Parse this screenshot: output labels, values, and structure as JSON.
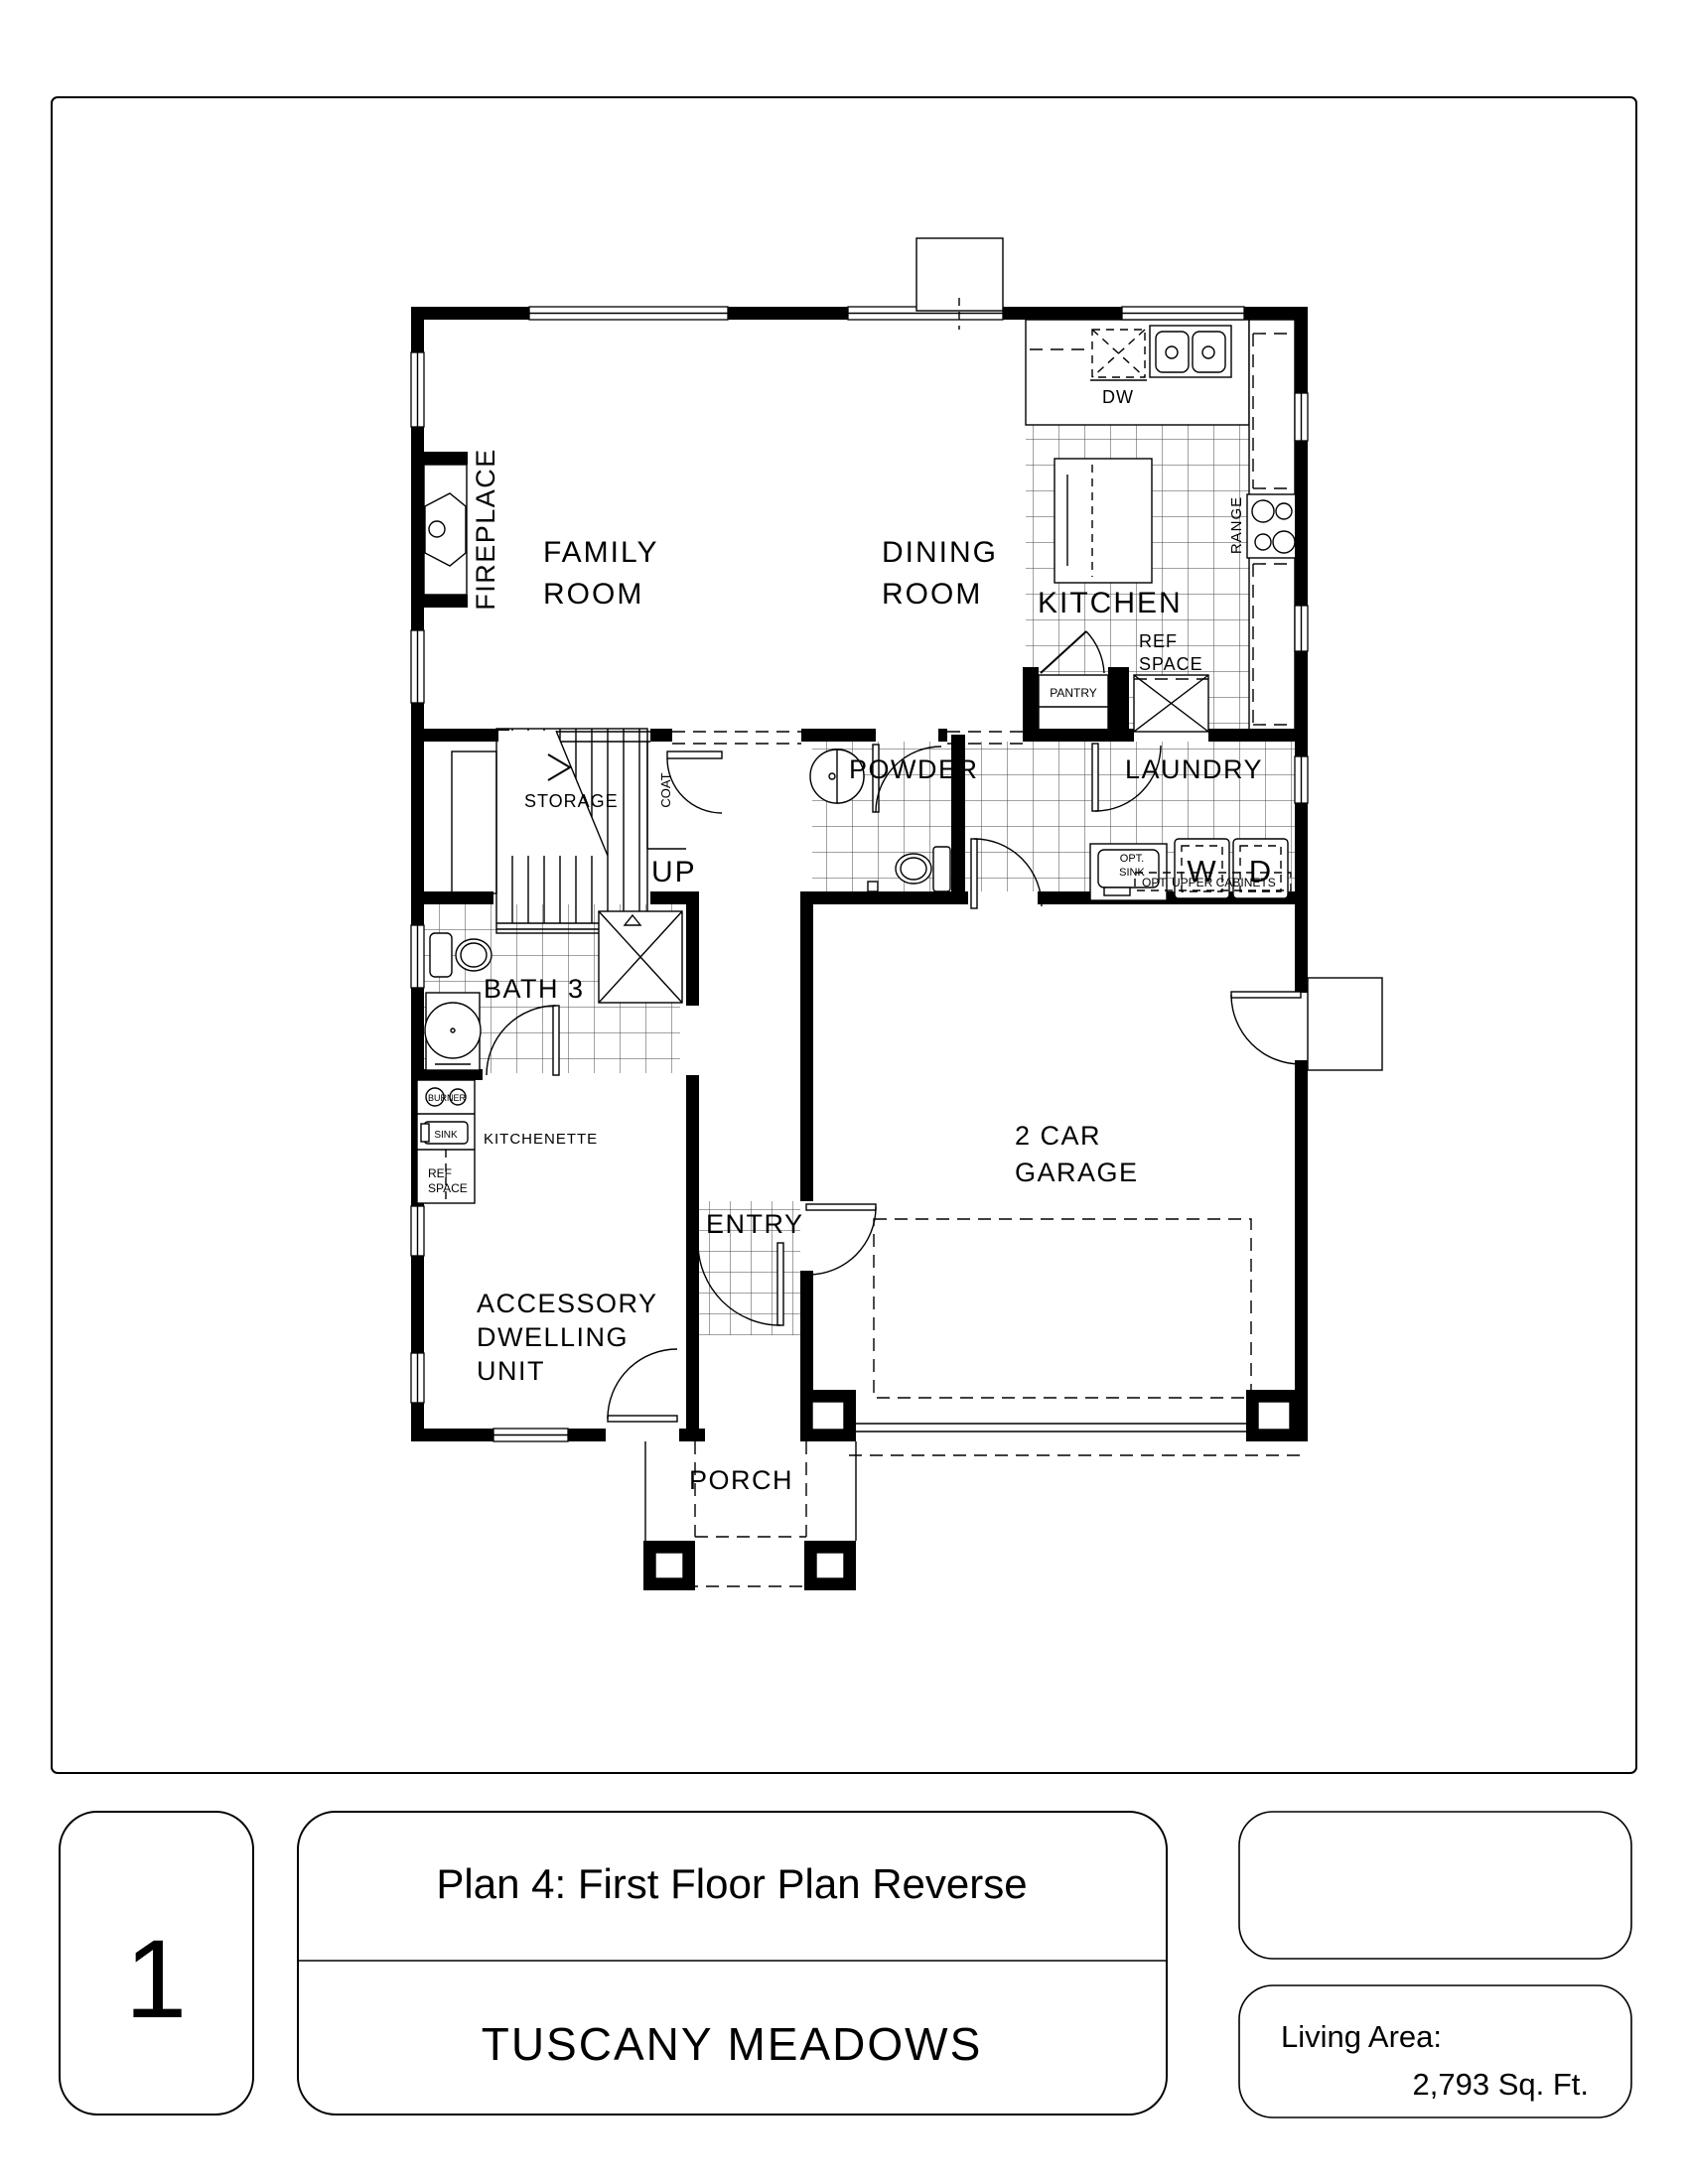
{
  "sheet": {
    "number": "1",
    "plan_title": "Plan 4: First Floor Plan Reverse",
    "community": "TUSCANY MEADOWS",
    "living_area_label": "Living Area:",
    "living_area_value": "2,793 Sq. Ft."
  },
  "rooms": {
    "family_room": {
      "line1": "FAMILY",
      "line2": "ROOM"
    },
    "dining_room": {
      "line1": "DINING",
      "line2": "ROOM"
    },
    "kitchen": {
      "label": "KITCHEN"
    },
    "powder": {
      "label": "POWDER"
    },
    "laundry": {
      "label": "LAUNDRY"
    },
    "storage": {
      "label": "STORAGE"
    },
    "bath3": {
      "label": "BATH 3"
    },
    "kitchenette": {
      "label": "KITCHENETTE"
    },
    "adu": {
      "line1": "ACCESSORY",
      "line2": "DWELLING",
      "line3": "UNIT"
    },
    "garage": {
      "line1": "2 CAR",
      "line2": "GARAGE"
    },
    "entry": {
      "label": "ENTRY"
    },
    "porch": {
      "label": "PORCH"
    }
  },
  "annotations": {
    "fireplace": "FIREPLACE",
    "coat": "COAT",
    "up": "UP",
    "dw": "DW",
    "range": "RANGE",
    "ref_line1": "REF",
    "ref_line2": "SPACE",
    "pantry": "PANTRY",
    "washer": "W",
    "dryer": "D",
    "opt_line1": "OPT.",
    "opt_line2": "SINK",
    "opt_upper_cabinets": "OPT. UPPER CABINETS",
    "burner": "BURNER",
    "sink": "SINK",
    "adu_ref_line1": "REF",
    "adu_ref_line2": "SPACE"
  },
  "colors": {
    "ink": "#000000",
    "paper": "#ffffff",
    "tile_line": "#444444"
  }
}
